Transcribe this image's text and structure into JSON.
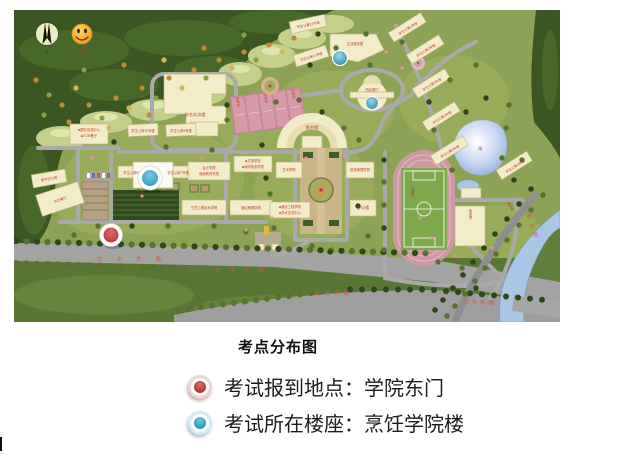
{
  "legend": {
    "title": "考点分布图",
    "items": [
      {
        "id": "checkin",
        "marker_color": "#b53434",
        "label": "考试报到地点：学院东门"
      },
      {
        "id": "exam-building",
        "marker_color": "#2e9abf",
        "label": "考试所在楼座：烹饪学院楼"
      }
    ]
  },
  "map": {
    "compass_label": "N",
    "smiley_label": "所在位置",
    "road_label": "九水东路",
    "river_label": "李村河",
    "riverside_road_label": "滨河路",
    "gate_label": "正门",
    "lake_label": "湖",
    "tennis_court_label": "网球场",
    "stadium_label": "运动场",
    "buildings": {
      "training": "综合实训楼",
      "library": "图书馆",
      "intl_center_l1": "■国际交流中心",
      "intl_center_l2": "■COM餐厅",
      "apt10": "学生公寓10号楼",
      "apt9": "学生公寓9号楼",
      "apt8": "学生公寓8号楼",
      "apt7": "学生公寓7号楼",
      "intl_apt": "留学生公寓",
      "east_dining": "东区餐厅",
      "accounting_l1": "会计学院",
      "accounting_l2": "继续教育学院",
      "wenlv_l1": "■文旅学院",
      "wenlv_l2": "■休闲旅游学院",
      "culinary_eng": "烹饪工程技术学院",
      "hotel_mgmt": "酒店管理学院",
      "tourism_mgmt": "旅游管理学院",
      "art": "艺术学院",
      "hotel_eng_l1": "■酒店工程学院",
      "hotel_eng_l2": "■学术交流中心",
      "office": "办公楼",
      "gym": "体育馆",
      "west_dining": "西区餐厅",
      "life_service": "生活服务楼",
      "apt11": "学生公寓11号楼",
      "apt12": "学生公寓12号楼",
      "apt1": "学生公寓1号楼",
      "apt2": "学生公寓2号楼",
      "apt3": "学生公寓3号楼",
      "apt4": "学生公寓4号楼",
      "apt5": "学生公寓5号楼",
      "apt6": "学生公寓6号楼"
    }
  }
}
